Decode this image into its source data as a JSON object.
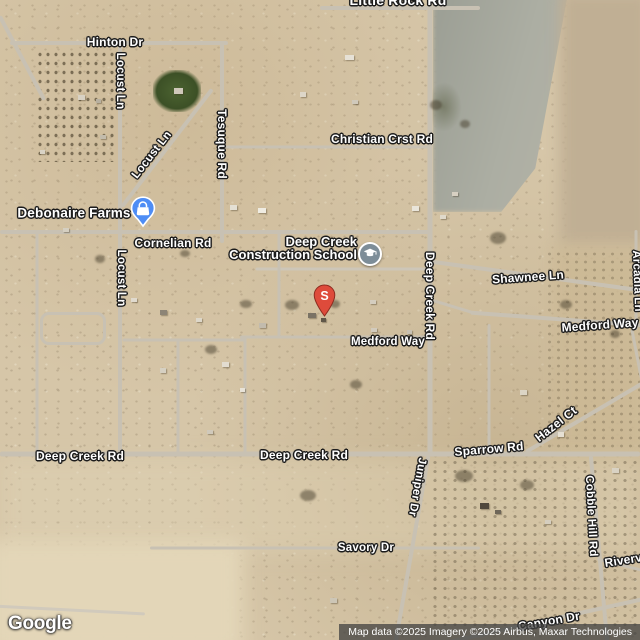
{
  "map": {
    "provider_logo": "Google",
    "attribution": "Map data ©2025 Imagery ©2025 Airbus, Maxar Technologies",
    "place_labels": {
      "debonaire_farms": {
        "text": "Debonaire Farms"
      },
      "deep_creek_school": {
        "line1": "Deep Creek",
        "line2": "Construction School"
      }
    },
    "road_labels": {
      "little_rock_rd": {
        "text": "Little Rock Rd"
      },
      "hinton_dr": {
        "text": "Hinton Dr"
      },
      "locust_ln_top": {
        "text": "Locust Ln"
      },
      "locust_ln_diag": {
        "text": "Locust Ln"
      },
      "locust_ln_mid": {
        "text": "Locust Ln"
      },
      "tesuque_rd": {
        "text": "Tesuque Rd"
      },
      "christian_crst_rd": {
        "text": "Christian Crst Rd"
      },
      "cornelian_rd": {
        "text": "Cornelian Rd"
      },
      "shawnee_ln": {
        "text": "Shawnee Ln"
      },
      "deep_creek_rd_vertical": {
        "text": "Deep Creek Rd"
      },
      "arcadia_ln": {
        "text": "Arcadia Ln"
      },
      "medford_way_east": {
        "text": "Medford Way"
      },
      "medford_way": {
        "text": "Medford Way"
      },
      "hazel_ct": {
        "text": "Hazel Ct"
      },
      "deep_creek_rd_west": {
        "text": "Deep Creek Rd"
      },
      "deep_creek_rd_center": {
        "text": "Deep Creek Rd"
      },
      "sparrow_rd": {
        "text": "Sparrow Rd"
      },
      "juniper_dr": {
        "text": "Juniper Dr"
      },
      "cobble_hill_rd": {
        "text": "Cobble Hill Rd"
      },
      "riverview_rd": {
        "text": "Riverview Rd"
      },
      "savory_dr": {
        "text": "Savory Dr"
      },
      "canyon_dr": {
        "text": "Canyon Dr"
      }
    },
    "markers": {
      "debonaire_pin": {
        "icon": "shopping-bag",
        "color": "#4e8df5"
      },
      "school_poi": {
        "icon": "graduation-cap",
        "color": "#7d8d98"
      },
      "s_pin": {
        "letter": "S",
        "color": "#de4b3b"
      }
    }
  }
}
